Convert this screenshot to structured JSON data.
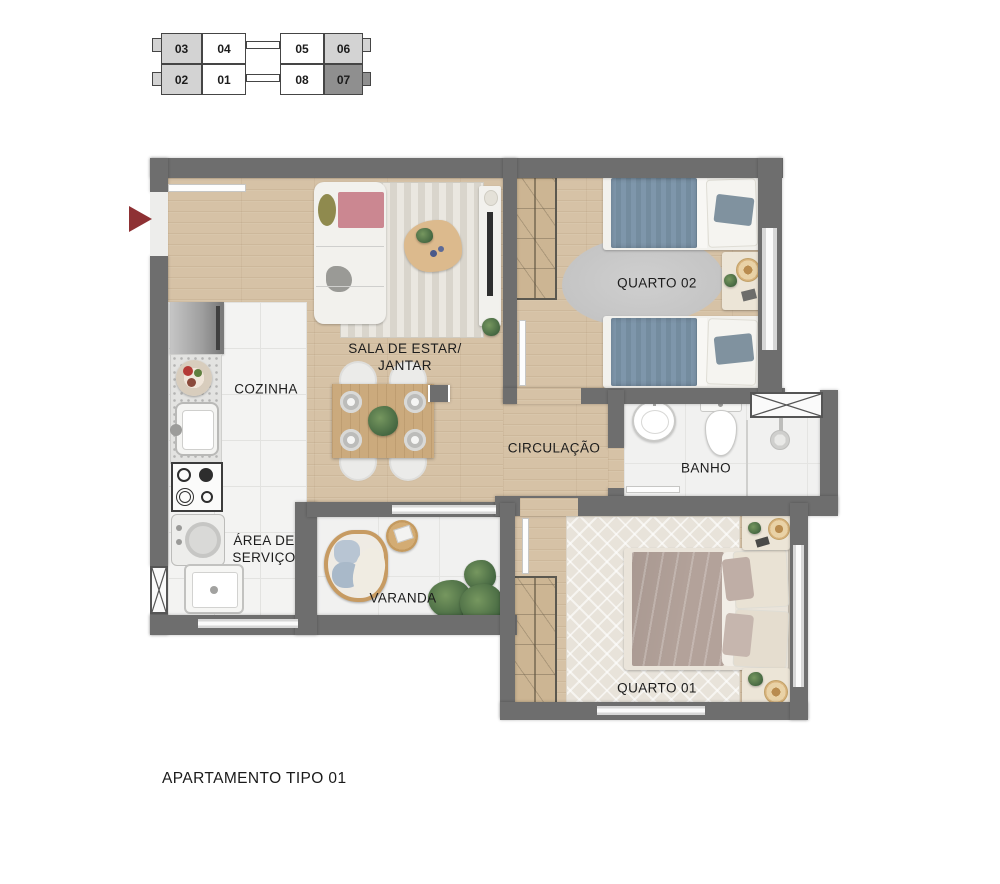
{
  "title": {
    "text": "APARTAMENTO TIPO 01"
  },
  "keyplan": {
    "units": [
      {
        "label": "03",
        "fill": "light"
      },
      {
        "label": "04",
        "fill": "white"
      },
      {
        "label": "05",
        "fill": "white"
      },
      {
        "label": "06",
        "fill": "light"
      },
      {
        "label": "02",
        "fill": "light"
      },
      {
        "label": "01",
        "fill": "white"
      },
      {
        "label": "08",
        "fill": "white"
      },
      {
        "label": "07",
        "fill": "dark"
      }
    ]
  },
  "rooms": {
    "sala": {
      "line1": "SALA DE ESTAR/",
      "line2": "JANTAR"
    },
    "cozinha": {
      "label": "COZINHA"
    },
    "area_servico": {
      "line1": "ÁREA DE",
      "line2": "SERVIÇO"
    },
    "varanda": {
      "label": "VARANDA"
    },
    "circulacao": {
      "label": "CIRCULAÇÃO"
    },
    "banho": {
      "label": "BANHO"
    },
    "quarto02": {
      "label": "QUARTO 02"
    },
    "quarto01": {
      "label": "QUARTO 01"
    }
  },
  "colors": {
    "wall": "#6e6e6e",
    "wood": "#d6c2a6",
    "tile": "#f3f3f2",
    "entrance_arrow": "#8e3134",
    "bed_blue": "#7e96ab",
    "bed_mauve": "#b3a29a",
    "sofa_throw_pink": "#cb8791",
    "keyplan_fills": {
      "light": "#d3d3d3",
      "white": "#ffffff",
      "dark": "#8f8f8f"
    }
  }
}
